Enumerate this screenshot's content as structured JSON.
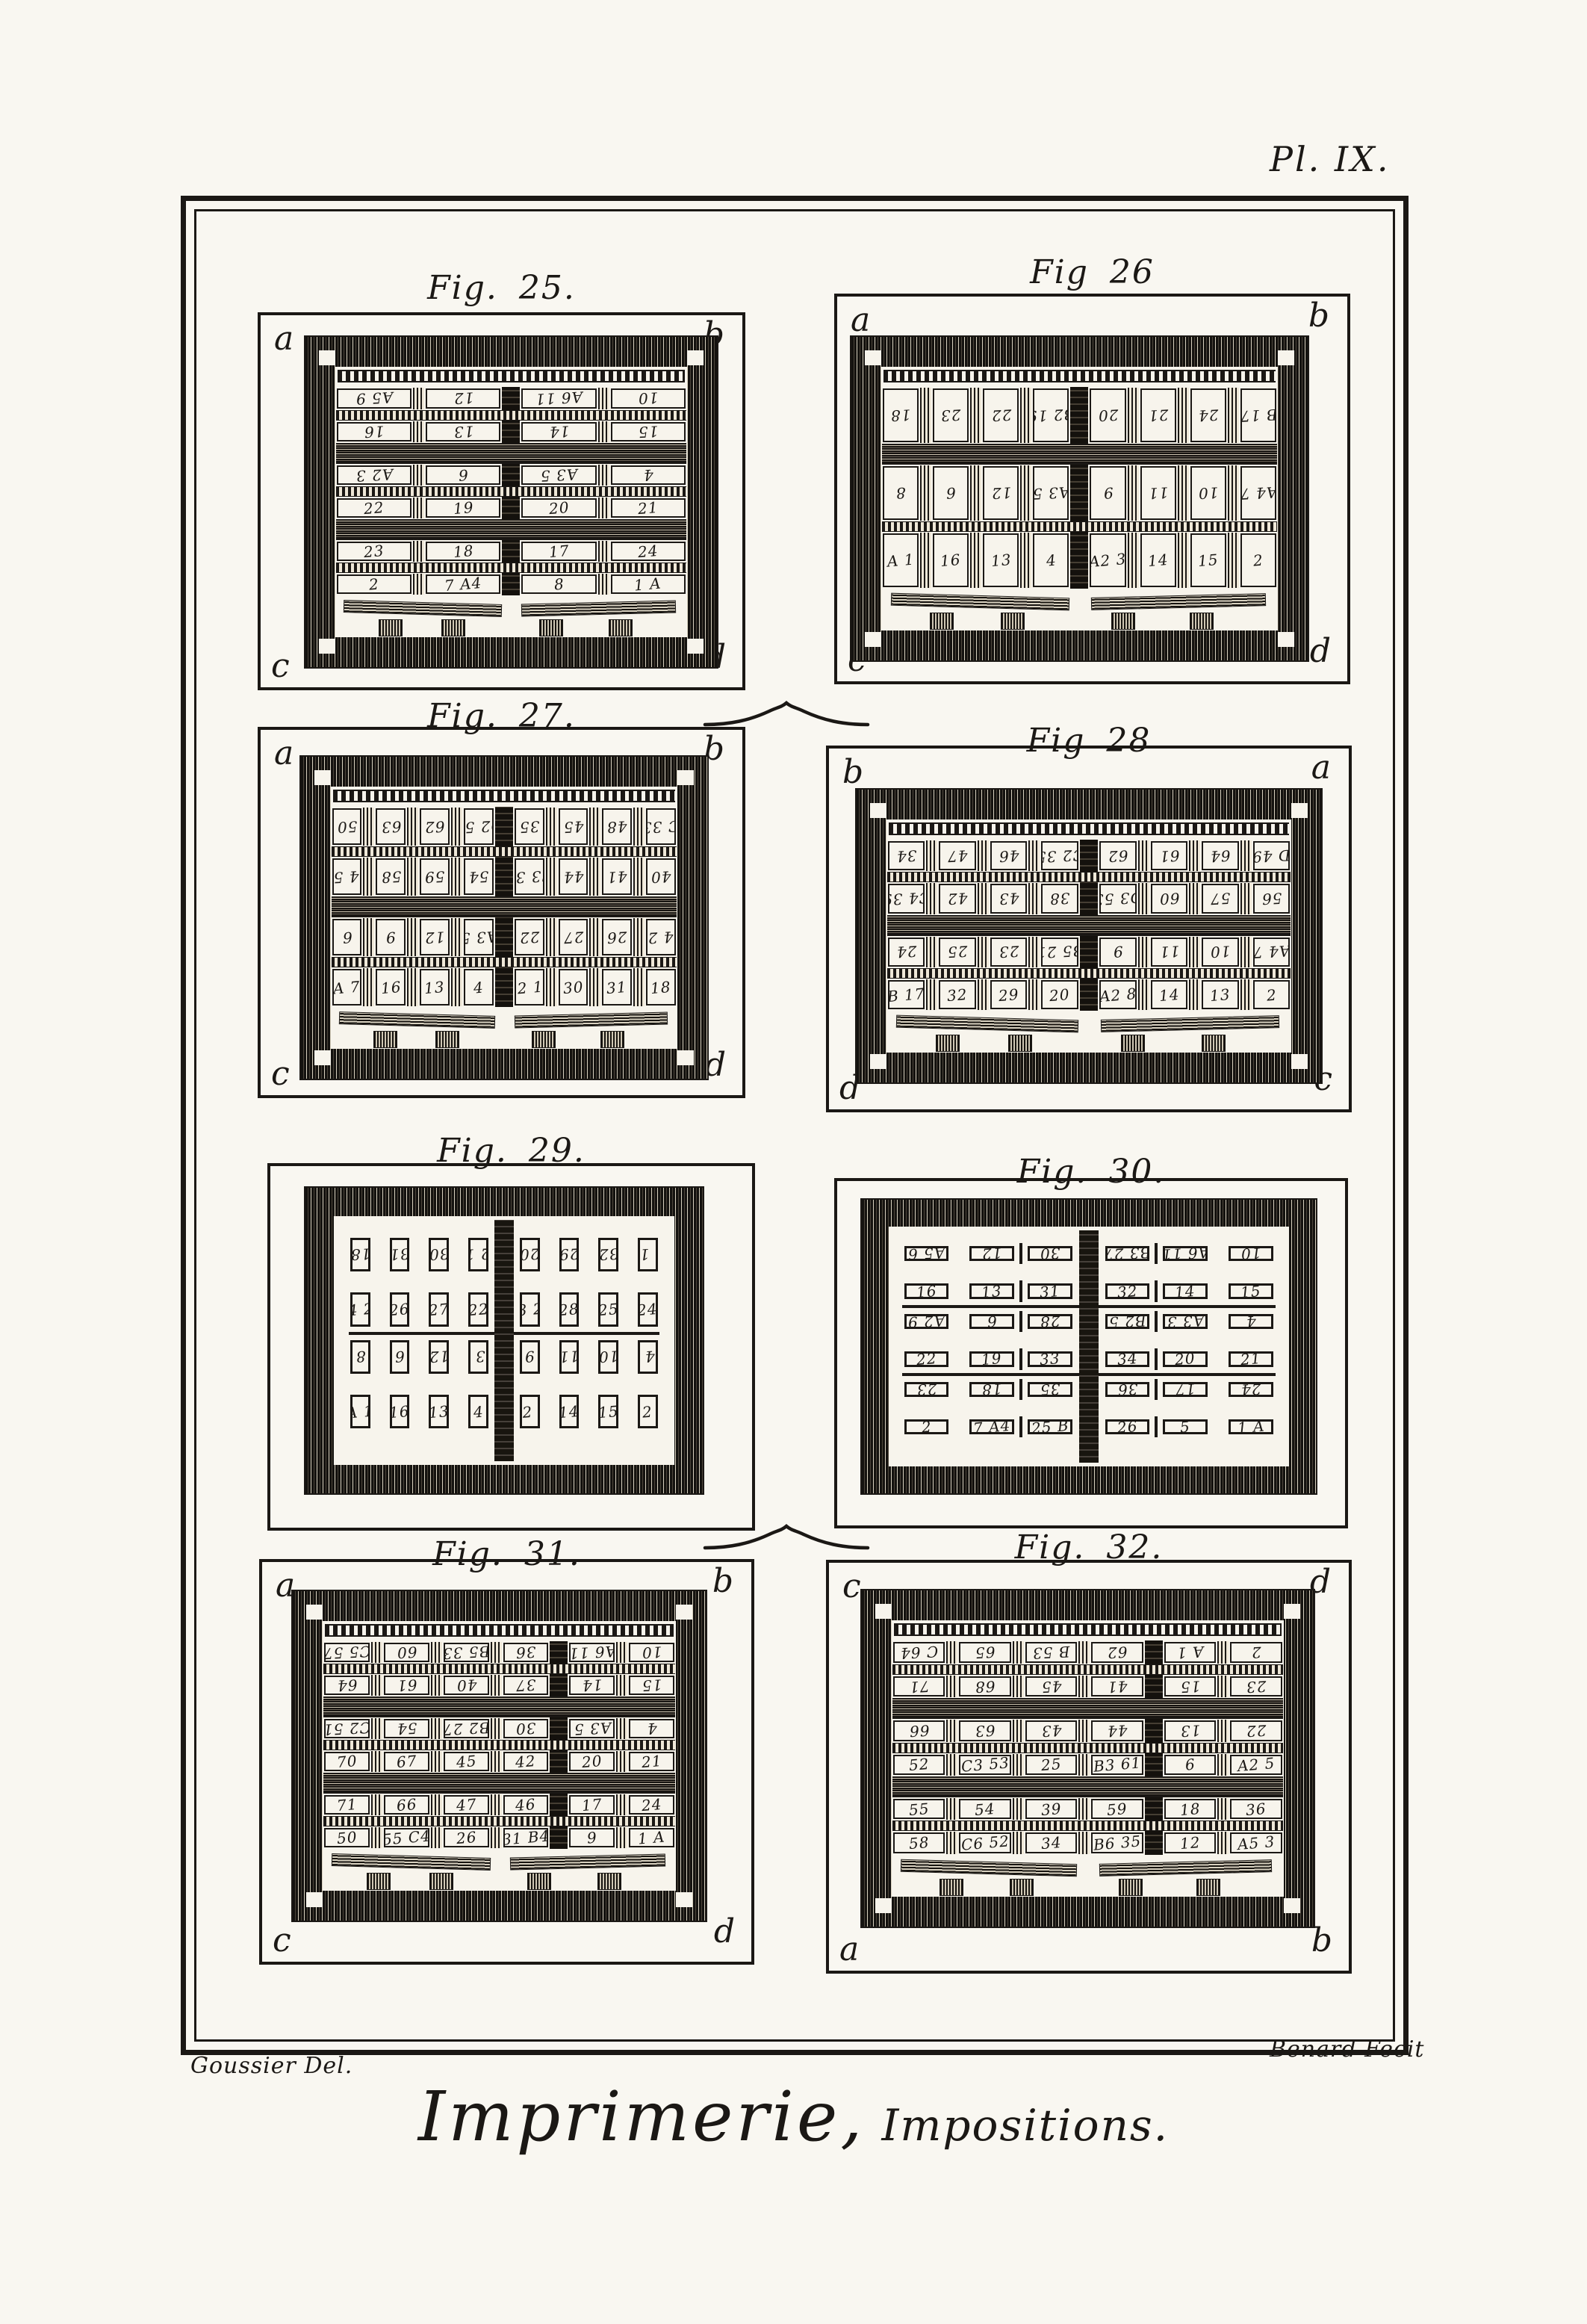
{
  "plate_label": "Pl. IX.",
  "credits": {
    "left": "Goussier Del.",
    "right": "Benard Fecit"
  },
  "caption": {
    "title": "Imprimerie,",
    "subtitle": "Impositions."
  },
  "colors": {
    "ink": "#1b1815",
    "paper": "#f9f7f1",
    "form_bg": "#f7f4ec"
  },
  "figures": [
    {
      "id": "fig25",
      "title": "Fig. 25.",
      "style": "chase",
      "corners": {
        "tl": "a",
        "tr": "b",
        "bl": "c",
        "br": "d"
      },
      "barcols": {
        "1": "mid",
        "2": "center",
        "3": "mid"
      },
      "rows": [
        {
          "flip": true,
          "bar": "thin",
          "cells": [
            "A5 9",
            "12",
            "A6 11",
            "10"
          ]
        },
        {
          "flip": true,
          "bar": "thick",
          "cells": [
            "16",
            "13",
            "14",
            "15"
          ]
        },
        {
          "flip": true,
          "bar": "thin",
          "cells": [
            "A2 3",
            "6",
            "A3 5",
            "4"
          ]
        },
        {
          "flip": false,
          "bar": "thick",
          "cells": [
            "22",
            "19",
            "20",
            "21"
          ]
        },
        {
          "flip": false,
          "bar": "thin",
          "cells": [
            "23",
            "18",
            "17",
            "24"
          ]
        },
        {
          "flip": false,
          "bar": "none",
          "cells": [
            "2",
            "7 A4",
            "8",
            "1 A"
          ]
        }
      ]
    },
    {
      "id": "fig26",
      "title": "Fig 26",
      "style": "chase",
      "corners": {
        "tl": "a",
        "tr": "b",
        "bl": "c",
        "br": "d"
      },
      "barcols": {
        "1": "mid",
        "2": "mid",
        "3": "mid",
        "4": "center",
        "5": "mid",
        "6": "mid",
        "7": "mid"
      },
      "rows": [
        {
          "flip": true,
          "bar": "thick",
          "cells": [
            "18",
            "23",
            "22",
            "B2 19",
            "20",
            "21",
            "24",
            "B 17"
          ]
        },
        {
          "flip": true,
          "bar": "thin",
          "cells": [
            "8",
            "6",
            "12",
            "A3 5",
            "9",
            "11",
            "10",
            "A4 7"
          ]
        },
        {
          "flip": false,
          "bar": "none",
          "cells": [
            "A 1",
            "16",
            "13",
            "4",
            "A2 3",
            "14",
            "15",
            "2"
          ]
        }
      ]
    },
    {
      "id": "fig27",
      "title": "Fig. 27.",
      "style": "chase",
      "corners": {
        "tl": "a",
        "tr": "b",
        "bl": "c",
        "br": "d"
      },
      "barcols": {
        "1": "mid",
        "2": "mid",
        "3": "mid",
        "4": "center",
        "5": "mid",
        "6": "mid",
        "7": "mid"
      },
      "rows": [
        {
          "flip": true,
          "bar": "thin",
          "cells": [
            "50",
            "63",
            "62",
            "D2 51",
            "35",
            "45",
            "48",
            "C 33"
          ]
        },
        {
          "flip": true,
          "bar": "thick",
          "cells": [
            "D4 55",
            "58",
            "59",
            "54",
            "C3 37",
            "44",
            "41",
            "40"
          ]
        },
        {
          "flip": true,
          "bar": "thin",
          "cells": [
            "6",
            "9",
            "12",
            "A3 5",
            "22",
            "27",
            "26",
            "B4 23"
          ]
        },
        {
          "flip": false,
          "bar": "none",
          "cells": [
            "A 7",
            "16",
            "13",
            "4",
            "B2 19",
            "30",
            "31",
            "18"
          ]
        }
      ]
    },
    {
      "id": "fig28",
      "title": "Fig 28",
      "style": "chase",
      "corners": {
        "tl": "b",
        "tr": "a",
        "bl": "d",
        "br": "c"
      },
      "barcols": {
        "1": "mid",
        "2": "mid",
        "3": "mid",
        "4": "center",
        "5": "mid",
        "6": "mid",
        "7": "mid"
      },
      "rows": [
        {
          "flip": true,
          "bar": "thin",
          "cells": [
            "34",
            "47",
            "46",
            "C2 35",
            "62",
            "61",
            "64",
            "D 49"
          ]
        },
        {
          "flip": true,
          "bar": "thick",
          "cells": [
            "C4 39",
            "42",
            "43",
            "38",
            "D3 53",
            "60",
            "57",
            "56"
          ]
        },
        {
          "flip": true,
          "bar": "thin",
          "cells": [
            "24",
            "25",
            "23",
            "B5 21",
            "9",
            "11",
            "10",
            "A4 7"
          ]
        },
        {
          "flip": false,
          "bar": "none",
          "cells": [
            "B 17",
            "32",
            "29",
            "20",
            "A2 8",
            "14",
            "13",
            "2"
          ]
        }
      ]
    },
    {
      "id": "fig29",
      "title": "Fig. 29.",
      "style": "plain",
      "centerline": true,
      "corners": {},
      "barcols": {
        "4": "gap2"
      },
      "rows": [
        {
          "flip": true,
          "bar": "gap",
          "cells": [
            "18",
            "31",
            "30",
            "B2 19",
            "20",
            "29",
            "32",
            "B 17"
          ]
        },
        {
          "flip": false,
          "bar": "line",
          "cells": [
            "B4 23",
            "26",
            "27",
            "22",
            "B3 21",
            "28",
            "25",
            "24"
          ]
        },
        {
          "flip": true,
          "bar": "gap",
          "cells": [
            "8",
            "6",
            "12",
            "A3 5",
            "9",
            "11",
            "10",
            "A4 7"
          ]
        },
        {
          "flip": false,
          "bar": "none",
          "cells": [
            "A 1",
            "16",
            "13",
            "4",
            "A2 3",
            "14",
            "15",
            "2"
          ]
        }
      ]
    },
    {
      "id": "fig30",
      "title": "Fig. 30.",
      "style": "boxes",
      "centerline": true,
      "corners": {},
      "barcols": {
        "2": "line",
        "3": "gap2",
        "4": "line"
      },
      "rows": [
        {
          "flip": true,
          "bar": "gap",
          "cells": [
            "A5 6",
            "12",
            "30",
            "B3 27",
            "A6 11",
            "10"
          ]
        },
        {
          "flip": false,
          "bar": "line",
          "cells": [
            "16",
            "13",
            "31",
            "32",
            "14",
            "15"
          ]
        },
        {
          "flip": true,
          "bar": "gap",
          "cells": [
            "A2 9",
            "6",
            "28",
            "B2 5",
            "A3 3",
            "4"
          ]
        },
        {
          "flip": false,
          "bar": "line",
          "cells": [
            "22",
            "19",
            "33",
            "34",
            "20",
            "21"
          ]
        },
        {
          "flip": true,
          "bar": "gap",
          "cells": [
            "23",
            "18",
            "35",
            "36",
            "17",
            "24"
          ]
        },
        {
          "flip": false,
          "bar": "none",
          "cells": [
            "2",
            "7 A4",
            "25 B",
            "26",
            "5",
            "1 A"
          ]
        }
      ]
    },
    {
      "id": "fig31",
      "title": "Fig. 31.",
      "style": "chase",
      "corners": {
        "tl": "a",
        "tr": "b",
        "bl": "c",
        "br": "d"
      },
      "barcols": {
        "1": "mid",
        "2": "mid",
        "3": "mid",
        "4": "center",
        "5": "mid"
      },
      "rows": [
        {
          "flip": true,
          "bar": "thin",
          "cells": [
            "C5 57",
            "60",
            "B5 33",
            "36",
            "A6 11",
            "10"
          ]
        },
        {
          "flip": true,
          "bar": "thick",
          "cells": [
            "64",
            "61",
            "40",
            "37",
            "14",
            "15"
          ]
        },
        {
          "flip": true,
          "bar": "thin",
          "cells": [
            "C2 51",
            "54",
            "B2 27",
            "30",
            "A3 5",
            "4"
          ]
        },
        {
          "flip": false,
          "bar": "thick",
          "cells": [
            "70",
            "67",
            "45",
            "42",
            "20",
            "21"
          ]
        },
        {
          "flip": false,
          "bar": "thin",
          "cells": [
            "71",
            "66",
            "47",
            "46",
            "17",
            "24"
          ]
        },
        {
          "flip": false,
          "bar": "none",
          "cells": [
            "50",
            "55 C4",
            "26",
            "31 B4",
            "9",
            "1 A"
          ]
        }
      ]
    },
    {
      "id": "fig32",
      "title": "Fig. 32.",
      "style": "chase",
      "corners": {
        "tl": "c",
        "tr": "d",
        "bl": "a",
        "br": "b"
      },
      "barcols": {
        "1": "mid",
        "2": "mid",
        "3": "mid",
        "4": "center",
        "5": "mid"
      },
      "rows": [
        {
          "flip": true,
          "bar": "thin",
          "cells": [
            "C 64",
            "65",
            "B 53",
            "62",
            "A 1",
            "2"
          ]
        },
        {
          "flip": true,
          "bar": "thick",
          "cells": [
            "71",
            "68",
            "45",
            "41",
            "15",
            "23"
          ]
        },
        {
          "flip": true,
          "bar": "thin",
          "cells": [
            "66",
            "63",
            "43",
            "44",
            "13",
            "22"
          ]
        },
        {
          "flip": false,
          "bar": "thick",
          "cells": [
            "52",
            "C3 53",
            "25",
            "B3 61",
            "6",
            "A2 5"
          ]
        },
        {
          "flip": false,
          "bar": "thin",
          "cells": [
            "55",
            "54",
            "39",
            "59",
            "18",
            "36"
          ]
        },
        {
          "flip": false,
          "bar": "none",
          "cells": [
            "58",
            "C6 52",
            "34",
            "B6 35",
            "12",
            "A5 3"
          ]
        }
      ]
    }
  ]
}
